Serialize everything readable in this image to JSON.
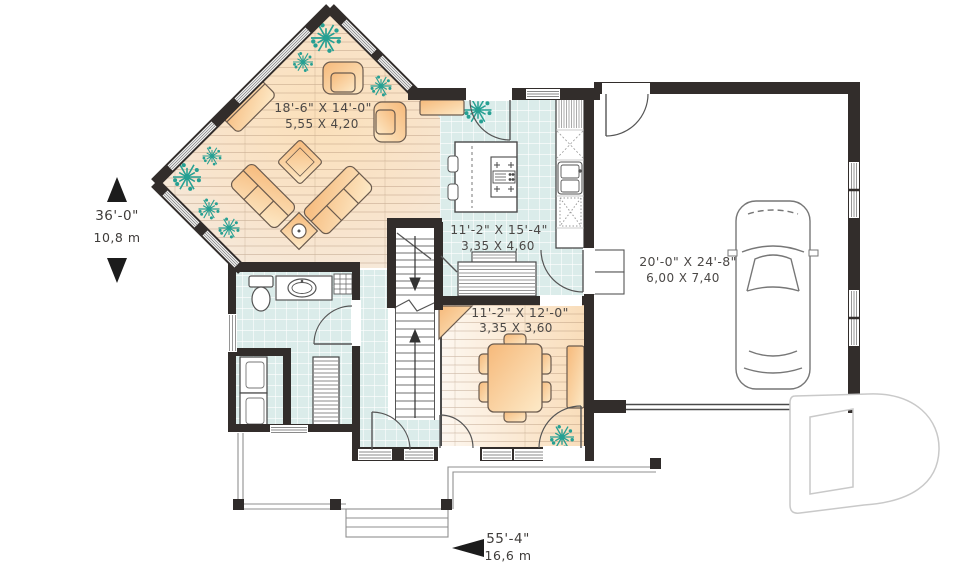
{
  "document": {
    "type": "first floor plan"
  },
  "rooms": {
    "living": {
      "imperial": "18'-6\" X 14'-0\"",
      "metric": "5,55 X 4,20"
    },
    "kitchen": {
      "imperial": "11'-2\" X 15'-4\"",
      "metric": "3,35 X 4,60"
    },
    "dining": {
      "imperial": "11'-2\" X 12'-0\"",
      "metric": "3,35 X 3,60"
    },
    "garage": {
      "imperial": "20'-0\" X 24'-8\"",
      "metric": "6,00 X 7,40"
    }
  },
  "overall_dimensions": {
    "depth": {
      "imperial": "36'-0\"",
      "metric": "10,8 m"
    },
    "width": {
      "imperial": "55'-4\"",
      "metric": "16,6 m"
    }
  },
  "colors": {
    "wall": "#322d2b",
    "wood_floor": "#f8e3c6",
    "tile_floor": "#dbecea",
    "furniture": "#f8c389",
    "plant": "#26a093",
    "text": "#4b4846",
    "logo_outline": "#c9c9c9"
  }
}
